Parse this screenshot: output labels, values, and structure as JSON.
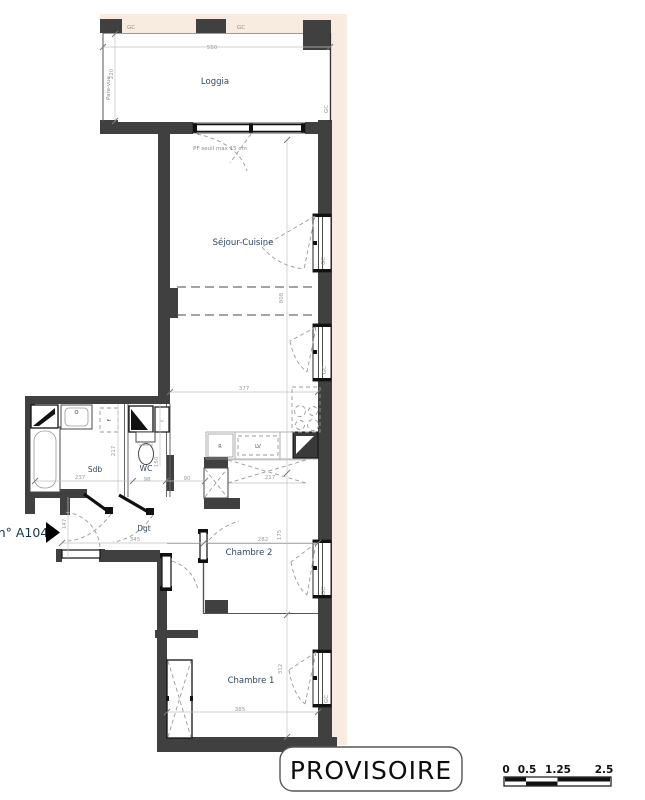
{
  "plan": {
    "rooms": {
      "loggia": "Loggia",
      "sejour_cuisine": "Séjour-Cuisine",
      "sdb": "Sdb",
      "wc": "WC",
      "dgt": "Dgt",
      "chambre2": "Chambre 2",
      "chambre1": "Chambre 1"
    },
    "dimensions_cm": {
      "loggia_width": "550",
      "loggia_depth": "220",
      "sejour_width": "377",
      "sejour_length": "808",
      "sdb_width": "237",
      "sdb_depth": "217",
      "wc_width": "98",
      "wc_depth": "150",
      "wc_passage": "90",
      "kitchen_worktop": "217",
      "dgt_depth": "147",
      "dgt_width": "345",
      "chambre2_width": "282",
      "chambre2_depth": "175",
      "chambre1_width": "385",
      "chambre1_depth": "312"
    },
    "annotations": {
      "pf_seuil": "PF  seuil max 15 cm",
      "pare_vue": "Pare-vue",
      "gc": "GC",
      "gaine": "F",
      "dishwasher": "LV",
      "fridge": "R",
      "water_heater": "~"
    },
    "unit_label": "n° A104",
    "stamp": "PROVISOIRE",
    "scale_bar": {
      "t0": "0",
      "t1": "0.5",
      "t2": "1.25",
      "t3": "2.5"
    }
  },
  "colors": {
    "wall": "#404040",
    "band": "#f7ecdf",
    "room_label": "#31465c",
    "dimension_label": "#9b9b9b",
    "stamp_text": "#0d0d0d"
  }
}
